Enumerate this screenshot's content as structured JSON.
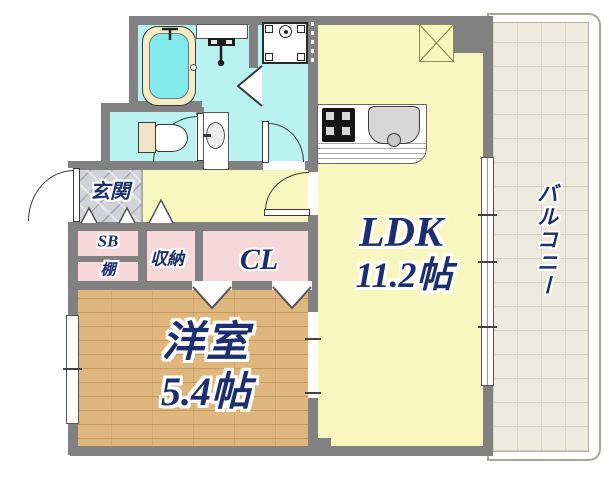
{
  "floorplan": {
    "labels": {
      "genkan": "玄関",
      "shoe_box": "SB",
      "shelf": "棚",
      "storage": "収納",
      "closet": "CL",
      "western_room": "洋室",
      "western_room_size": "5.4帖",
      "ldk": "LDK",
      "ldk_size": "11.2帖",
      "balcony": "バルコニー"
    },
    "colors": {
      "wall": "#818181",
      "wet": "#baf1f1",
      "living": "#f9f7c0",
      "closet": "#f5d8d7",
      "wood": "#dfb77e",
      "entry": "#d2d2d9",
      "balcony": "#edeadf",
      "balcony-line": "#d5d2c2",
      "text": "#1c2d70",
      "tub-water": "#82eaea",
      "tub-rim": "#f4ecc4"
    }
  }
}
